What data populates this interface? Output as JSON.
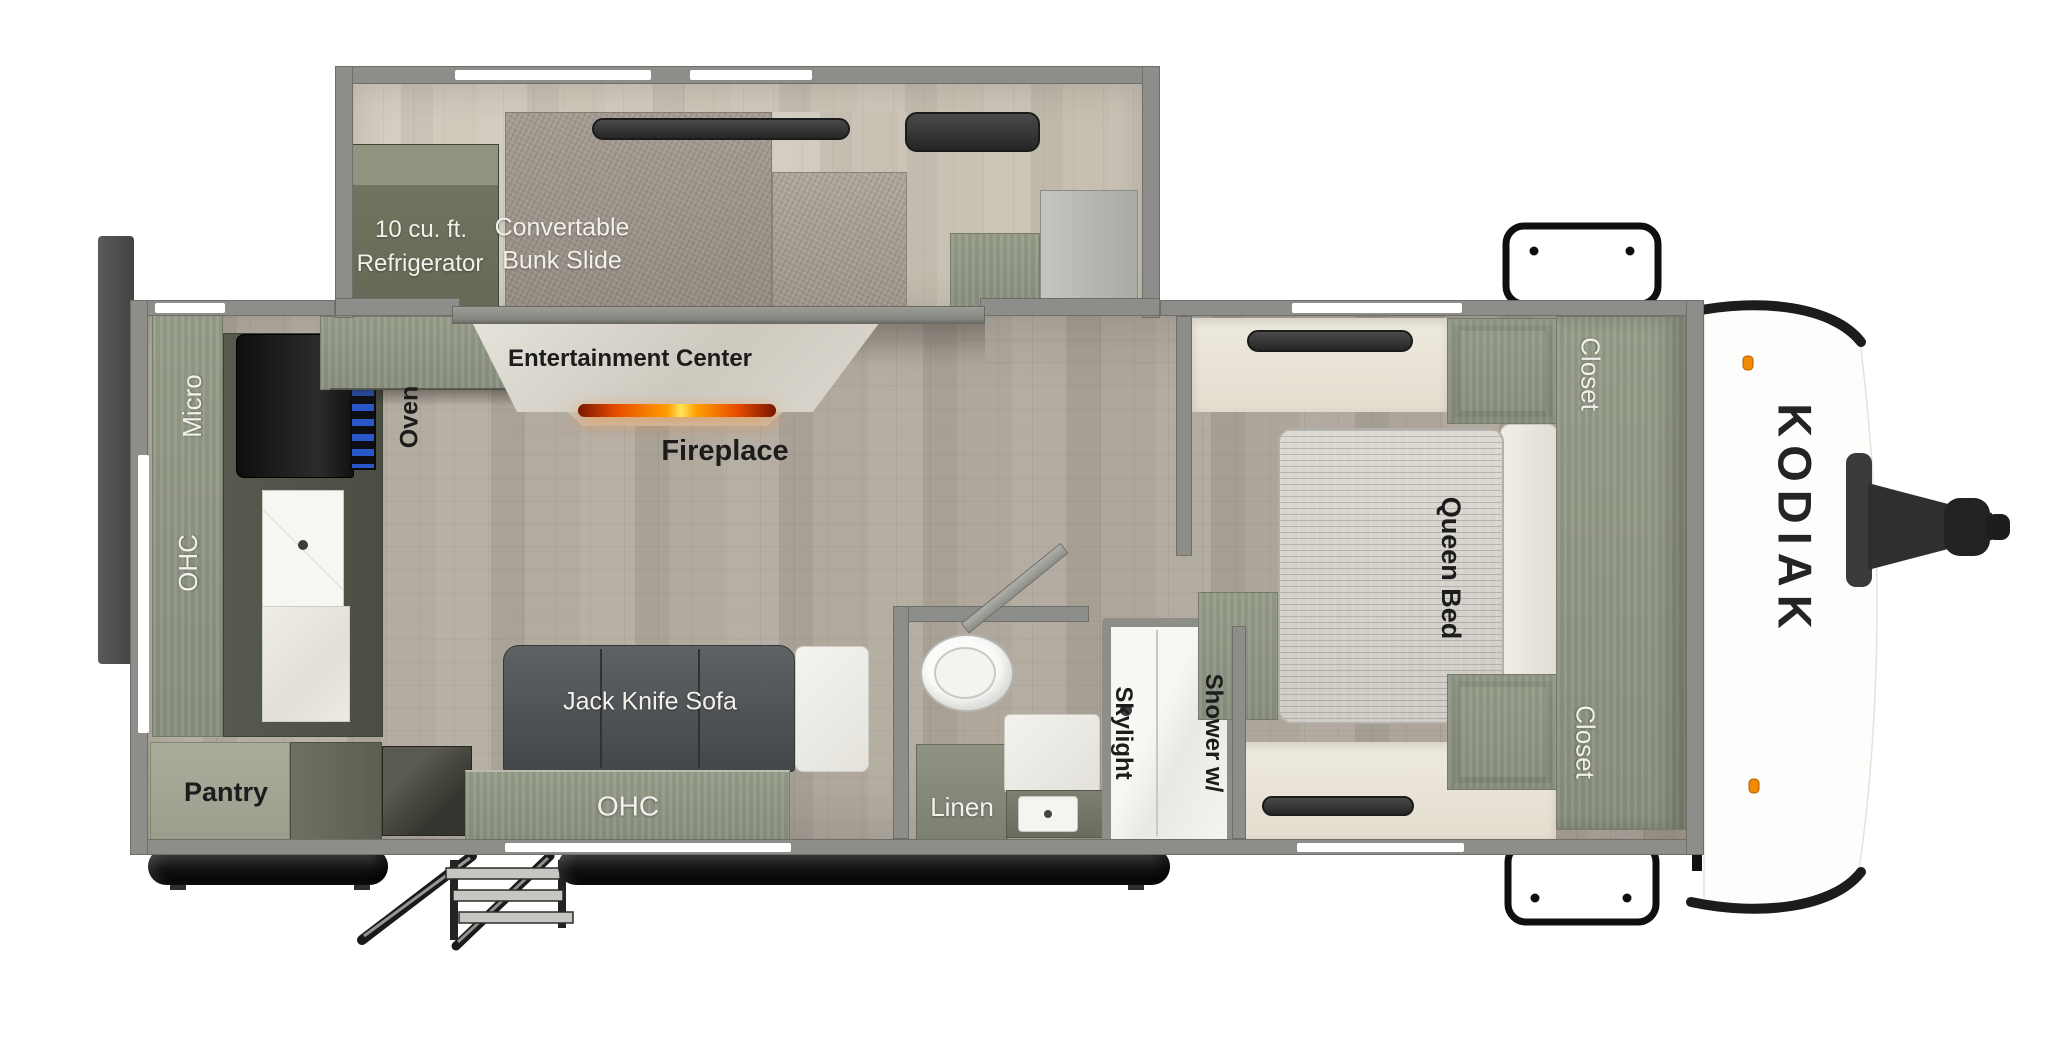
{
  "brand": "KODIAK",
  "slideout": {
    "refrigerator_l1": "10 cu. ft.",
    "refrigerator_l2": "Refrigerator",
    "bunk_l1": "Convertable",
    "bunk_l2": "Bunk Slide"
  },
  "living": {
    "entertainment": "Entertainment Center",
    "fireplace": "Fireplace",
    "sofa": "Jack Knife Sofa",
    "sofa_ohc": "OHC"
  },
  "kitchen": {
    "micro": "Micro",
    "ohc": "OHC",
    "oven": "Oven",
    "pantry": "Pantry"
  },
  "bath": {
    "linen": "Linen",
    "shower_l1": "Shower w/",
    "shower_l2": "Skylight"
  },
  "bedroom": {
    "bed": "Queen Bed",
    "closet_front": "Closet",
    "closet_rear": "Closet"
  },
  "colors": {
    "wall": "#8d8d89",
    "cabinet_sage": "#8f9381",
    "floor_wood": "#b3aba0",
    "sofa_leather": "#4c5052",
    "fireplace_glow": "#ff9d00",
    "marker_light": "#f18a00",
    "trim_black": "#1c1c1c",
    "label_light": "#f2f1ec",
    "label_dark": "#1c1c1c"
  }
}
